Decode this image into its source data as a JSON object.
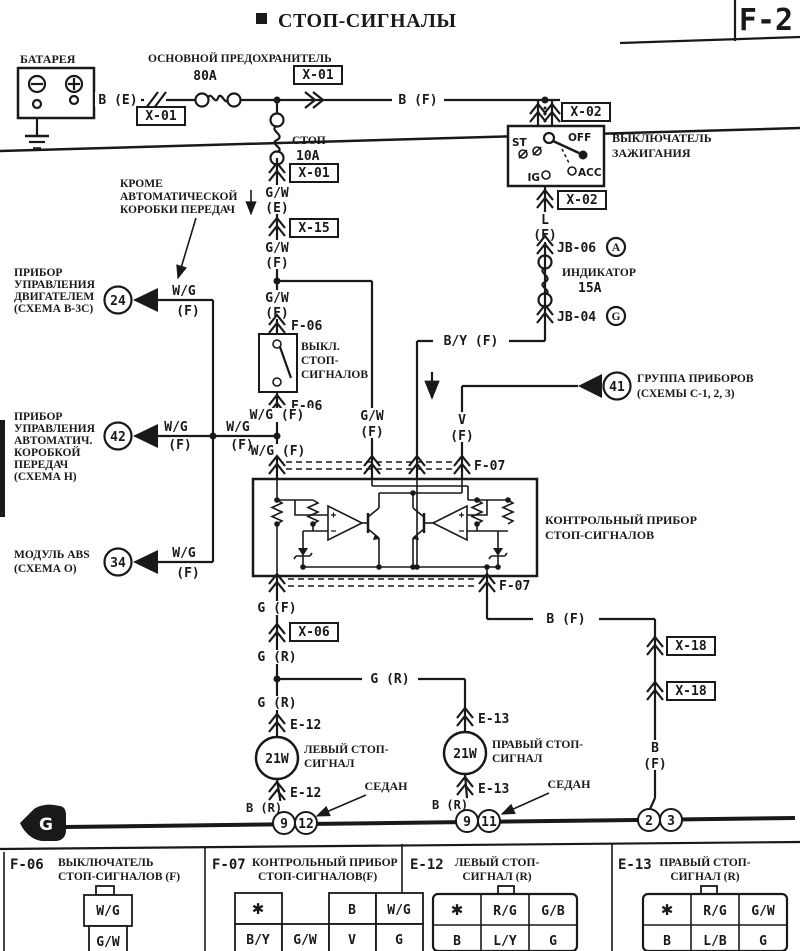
{
  "header": {
    "title": "СТОП-СИГНАЛЫ",
    "page_code": "F-2"
  },
  "battery": {
    "label": "БАТАРЕЯ"
  },
  "fuses": {
    "main_label": "ОСНОВНОЙ ПРЕДОХРАНИТЕЛЬ",
    "main_rating": "80A",
    "stop_label": "СТОП",
    "stop_rating": "10A",
    "indicator_label": "ИНДИКАТОР",
    "indicator_rating": "15A"
  },
  "ignition": {
    "label_1": "ВЫКЛЮЧАТЕЛЬ",
    "label_2": "ЗАЖИГАНИЯ",
    "pos_st": "ST",
    "pos_off": "OFF",
    "pos_ig": "IG",
    "pos_acc": "ACC"
  },
  "connectors": {
    "x01_battery": "X-01",
    "x01_main": "X-01",
    "x01_stop": "X-01",
    "x02_top": "X-02",
    "x02_bottom": "X-02",
    "x15": "X-15",
    "x06": "X-06",
    "x18_top": "X-18",
    "x18_bottom": "X-18",
    "f06_top": "F-06",
    "f06_bottom": "F-06",
    "f07_top": "F-07",
    "f07_bottom": "F-07",
    "e12_top": "E-12",
    "e12_bottom": "E-12",
    "e13_top": "E-13",
    "e13_bottom": "E-13",
    "jb06": "JB-06",
    "jb06_letter": "A",
    "jb04": "JB-04",
    "jb04_letter": "G"
  },
  "wires": {
    "b_e": "B (E)",
    "b_f_top": "B (F)",
    "l": "L",
    "l_f": "(F)",
    "b_y": "B/Y (F)",
    "gw_e_1": "G/W",
    "gw_e_2": "(E)",
    "gw_f1_1": "G/W",
    "gw_f1_2": "(F)",
    "gw_f2_1": "G/W",
    "gw_f2_2": "(F)",
    "gw_branch_1": "G/W",
    "gw_branch_2": "(F)",
    "wg_above": "W/G (F)",
    "wg_below": "W/G (F)",
    "wg_left1_1": "W/G",
    "wg_left1_2": "(F)",
    "wg_left2_1": "W/G",
    "wg_left2_2": "(F)",
    "v_1": "V",
    "v_2": "(F)",
    "g_f": "G (F)",
    "g_r_1": "G (R)",
    "g_r_branch": "G (R)",
    "g_r_2": "G (R)",
    "b_f_right": "B (F)",
    "b_right_1": "B",
    "b_right_2": "(F)",
    "b_r_left": "B (R)",
    "b_r_right": "B (R)"
  },
  "note_mt": {
    "line_1": "КРОМЕ",
    "line_2": "АВТОМАТИЧЕСКОЙ",
    "line_3": "КОРОБКИ ПЕРЕДАЧ"
  },
  "units": {
    "engine": {
      "lines": [
        "ПРИБОР",
        "УПРАВЛЕНИЯ",
        "ДВИГАТЕЛЕМ",
        "(СХЕМА B-3C)"
      ],
      "pin": "24",
      "wire_1": "W/G",
      "wire_2": "(F)"
    },
    "at": {
      "lines": [
        "ПРИБОР",
        "УПРАВЛЕНИЯ",
        "АВТОМАТИЧ.",
        "КОРОБКОЙ",
        "ПЕРЕДАЧ",
        "(СХЕМА H)"
      ],
      "pin": "42"
    },
    "abs": {
      "lines": [
        "МОДУЛЬ ABS",
        "(СХЕМА O)"
      ],
      "pin": "34",
      "wire_1": "W/G",
      "wire_2": "(F)"
    },
    "cluster": {
      "lines": [
        "ГРУППА ПРИБОРОВ",
        "(СХЕМЫ C-1, 2, 3)"
      ],
      "pin": "41"
    }
  },
  "stop_switch": {
    "lines": [
      "ВЫКЛ.",
      "СТОП-",
      "СИГНАЛОВ"
    ]
  },
  "control_unit": {
    "label_1": "КОНТРОЛЬНЫЙ ПРИБОР",
    "label_2": "СТОП-СИГНАЛОВ"
  },
  "lamps": {
    "left": {
      "power": "21W",
      "label_1": "ЛЕВЫЙ СТОП-",
      "label_2": "СИГНАЛ"
    },
    "right": {
      "power": "21W",
      "label_1": "ПРАВЫЙ СТОП-",
      "label_2": "СИГНАЛ"
    }
  },
  "sedan_note_1": "СЕДАН",
  "sedan_note_2": "СЕДАН",
  "ground": {
    "symbol": "G",
    "pins": [
      "9",
      "12",
      "9",
      "11",
      "2",
      "3"
    ]
  },
  "tables": [
    {
      "code": "F-06",
      "title_1": "ВЫКЛЮЧАТЕЛЬ",
      "title_2": "СТОП-СИГНАЛОВ (F)",
      "cells": [
        "W/G",
        "G/W"
      ]
    },
    {
      "code": "F-07",
      "title_1": "КОНТРОЛЬНЫЙ ПРИБОР",
      "title_2": "СТОП-СИГНАЛОВ(F)",
      "row_1": [
        "✱",
        "B",
        "W/G"
      ],
      "row_2": [
        "B/Y",
        "G/W",
        "V",
        "G"
      ]
    },
    {
      "code": "E-12",
      "title_1": "ЛЕВЫЙ СТОП-",
      "title_2": "СИГНАЛ (R)",
      "row_1": [
        "✱",
        "R/G",
        "G/B"
      ],
      "row_2": [
        "B",
        "L/Y",
        "G"
      ]
    },
    {
      "code": "E-13",
      "title_1": "ПРАВЫЙ СТОП-",
      "title_2": "СИГНАЛ (R)",
      "row_1": [
        "✱",
        "R/G",
        "G/W"
      ],
      "row_2": [
        "B",
        "L/B",
        "G"
      ]
    }
  ]
}
